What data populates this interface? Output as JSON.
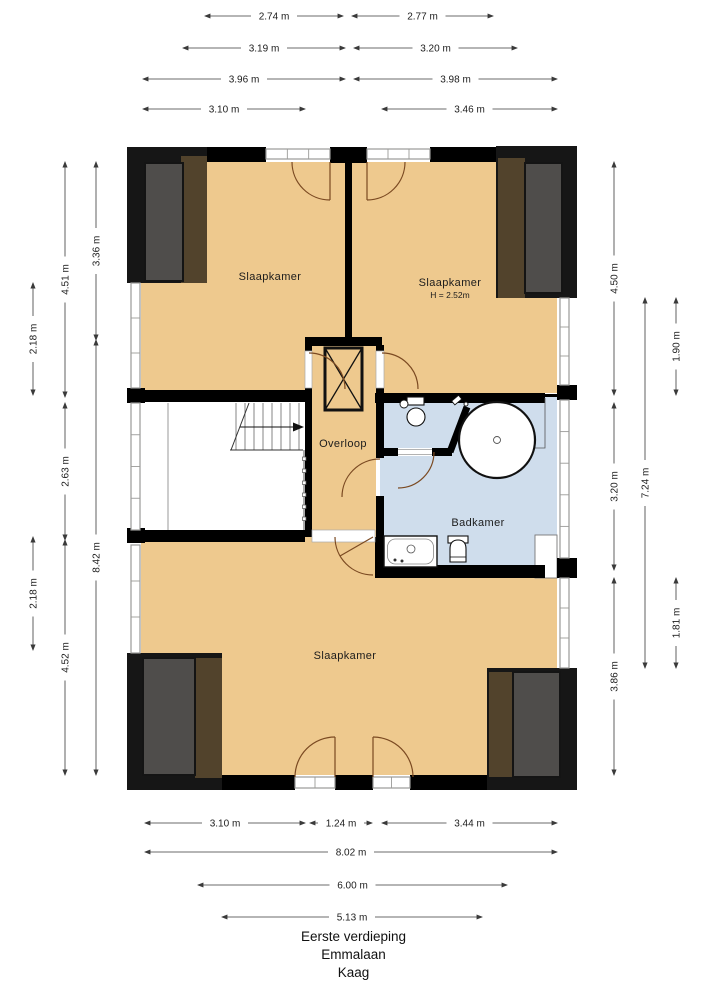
{
  "colors": {
    "floor": "#eec98e",
    "bathroom_floor": "#cfddec",
    "wall": "#000000",
    "dormer_black": "#161616",
    "dormer_brown": "#52432c",
    "dormer_gray": "#4f4d4b",
    "door_arc": "#7b4a22",
    "window_line": "#9a9a98",
    "dim_line": "#3a3a3a",
    "dim_text": "#1c1c1c",
    "label_text": "#1c1c1c"
  },
  "rooms": {
    "bedroom_top_left": {
      "label": "Slaapkamer"
    },
    "bedroom_top_right": {
      "label": "Slaapkamer",
      "height_note": "H = 2.52m"
    },
    "landing": {
      "label": "Overloop"
    },
    "bathroom": {
      "label": "Badkamer"
    },
    "bedroom_bottom": {
      "label": "Slaapkamer"
    }
  },
  "dimensions": {
    "top": [
      {
        "label": "2.74 m",
        "x1": 205,
        "x2": 343,
        "y": 16
      },
      {
        "label": "2.77 m",
        "x1": 352,
        "x2": 493,
        "y": 16
      },
      {
        "label": "3.19 m",
        "x1": 183,
        "x2": 345,
        "y": 48
      },
      {
        "label": "3.20 m",
        "x1": 354,
        "x2": 517,
        "y": 48
      },
      {
        "label": "3.96 m",
        "x1": 143,
        "x2": 345,
        "y": 79
      },
      {
        "label": "3.98 m",
        "x1": 354,
        "x2": 557,
        "y": 79
      },
      {
        "label": "3.10 m",
        "x1": 143,
        "x2": 305,
        "y": 109
      },
      {
        "label": "3.46 m",
        "x1": 382,
        "x2": 557,
        "y": 109
      }
    ],
    "bottom": [
      {
        "label": "3.10 m",
        "x1": 145,
        "x2": 305,
        "y": 823
      },
      {
        "label": "1.24 m",
        "x1": 310,
        "x2": 372,
        "y": 823
      },
      {
        "label": "3.44 m",
        "x1": 382,
        "x2": 557,
        "y": 823
      },
      {
        "label": "8.02 m",
        "x1": 145,
        "x2": 557,
        "y": 852
      },
      {
        "label": "6.00 m",
        "x1": 198,
        "x2": 507,
        "y": 885
      },
      {
        "label": "5.13 m",
        "x1": 222,
        "x2": 482,
        "y": 917
      }
    ],
    "left": [
      {
        "label": "2.18 m",
        "y1": 283,
        "y2": 395,
        "x": 33
      },
      {
        "label": "2.18 m",
        "y1": 537,
        "y2": 650,
        "x": 33
      },
      {
        "label": "4.51 m",
        "y1": 162,
        "y2": 397,
        "x": 65
      },
      {
        "label": "2.63 m",
        "y1": 403,
        "y2": 540,
        "x": 65
      },
      {
        "label": "4.52 m",
        "y1": 540,
        "y2": 775,
        "x": 65
      },
      {
        "label": "3.36 m",
        "y1": 162,
        "y2": 340,
        "x": 96
      },
      {
        "label": "8.42 m",
        "y1": 340,
        "y2": 775,
        "x": 96
      }
    ],
    "right": [
      {
        "label": "4.50 m",
        "y1": 162,
        "y2": 395,
        "x": 614
      },
      {
        "label": "3.20 m",
        "y1": 403,
        "y2": 570,
        "x": 614
      },
      {
        "label": "3.86 m",
        "y1": 578,
        "y2": 775,
        "x": 614
      },
      {
        "label": "7.24 m",
        "y1": 298,
        "y2": 668,
        "x": 645
      },
      {
        "label": "1.90 m",
        "y1": 298,
        "y2": 395,
        "x": 676
      },
      {
        "label": "1.81 m",
        "y1": 578,
        "y2": 668,
        "x": 676
      }
    ]
  },
  "footer": {
    "line1": "Eerste verdieping",
    "line2": "Emmalaan",
    "line3": "Kaag"
  }
}
